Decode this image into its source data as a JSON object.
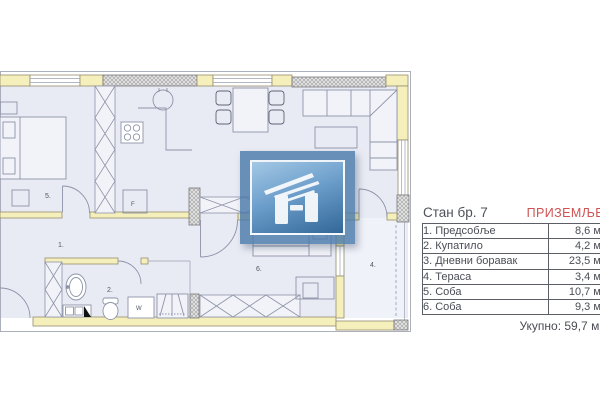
{
  "plan": {
    "rooms": {
      "hallway": {
        "label": "1."
      },
      "bathroom": {
        "label": "2."
      },
      "living_room": {
        "label": "3."
      },
      "terrace": {
        "label": "4."
      },
      "bedroom_1": {
        "label": "5."
      },
      "bedroom_2": {
        "label": "6."
      }
    },
    "fixtures": {
      "fridge": "F",
      "washing_machine": "W"
    }
  },
  "table": {
    "title": "Стан бр. 7",
    "floor_label": "ПРИЗЕМЉЕ",
    "rows": [
      {
        "name": "1. Предсобље",
        "area": "8,6 м2"
      },
      {
        "name": "2. Купатило",
        "area": "4,2 м2"
      },
      {
        "name": "3. Дневни боравак",
        "area": "23,5 м2"
      },
      {
        "name": "4. Тераса",
        "area": "3,4 м2"
      },
      {
        "name": "5. Соба",
        "area": "10,7 м2"
      },
      {
        "name": "6. Соба",
        "area": "9,3 м2"
      }
    ],
    "total": "Укупно: 59,7 м2"
  },
  "colors": {
    "wall_fill": "#f5efbb",
    "wall_stroke": "#948d6d",
    "floor_fill": "#e9ebf4",
    "furniture_stroke": "#8d93a8",
    "accent_red": "#d05252",
    "watermark_blue": "#4a7aa9",
    "table_border": "#5c5e66"
  }
}
